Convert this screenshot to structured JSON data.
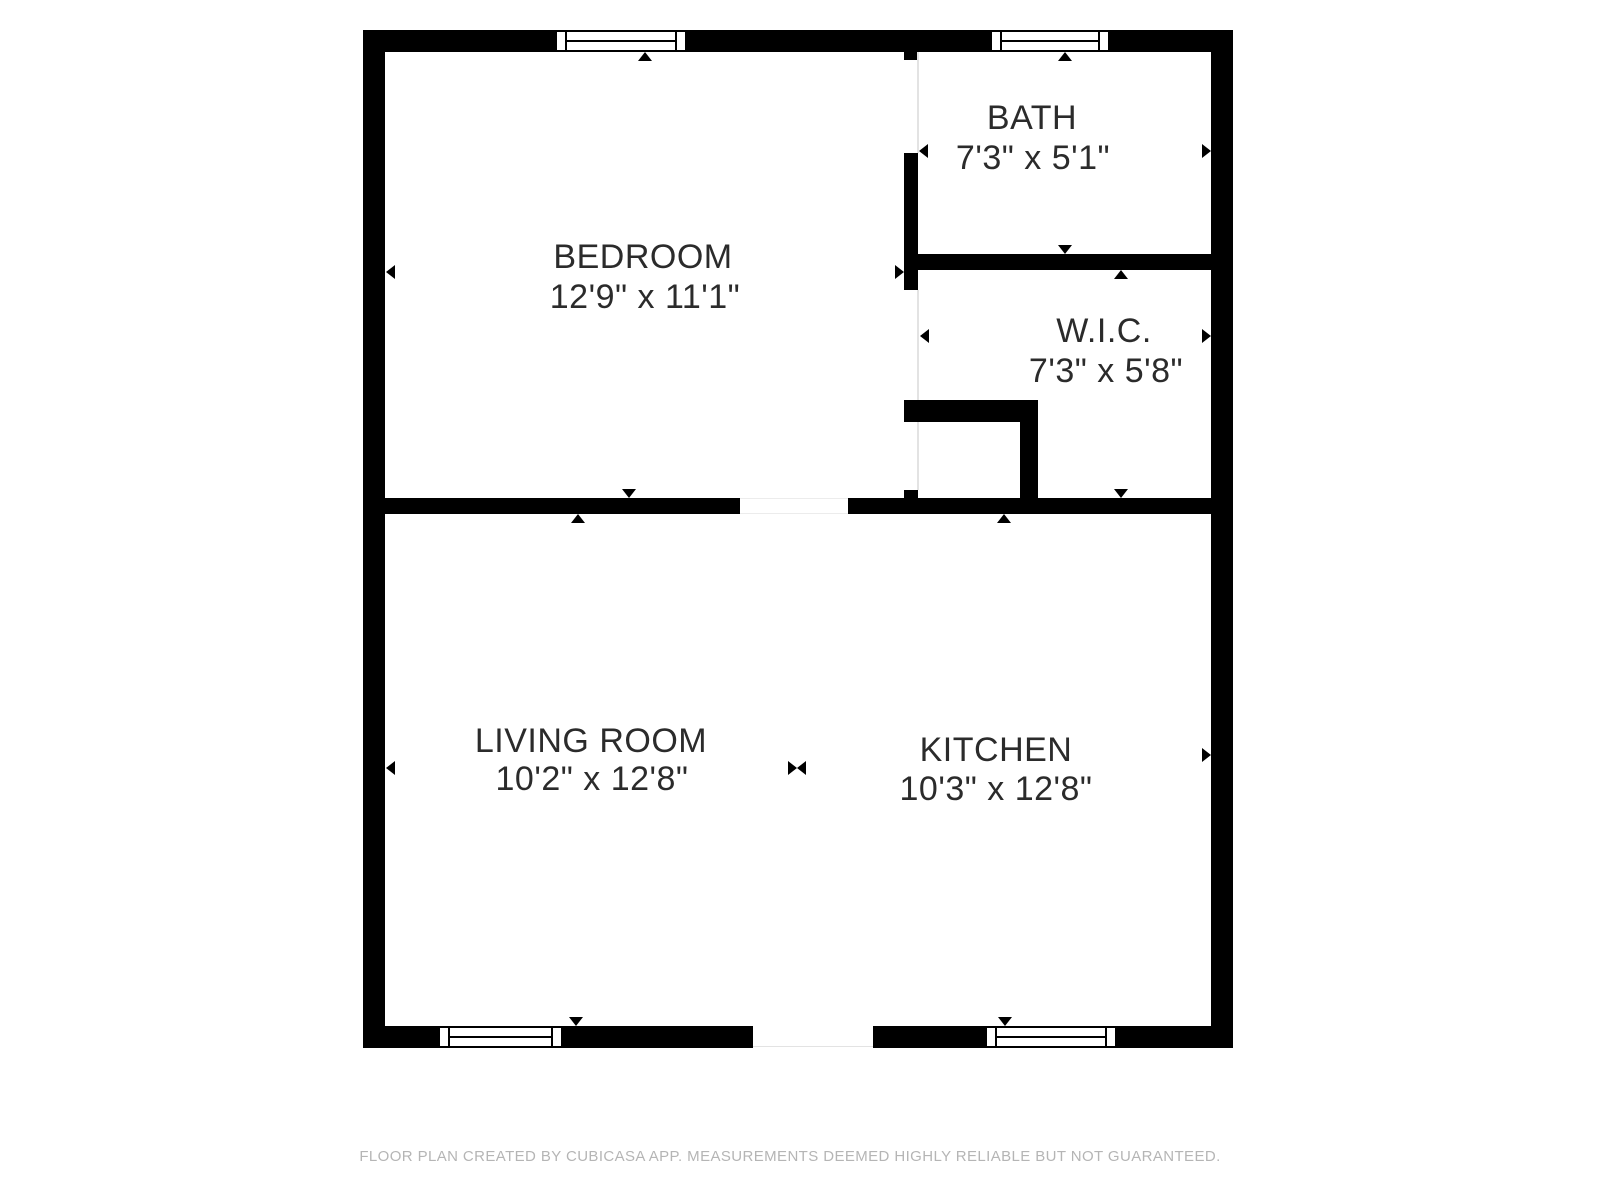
{
  "plan": {
    "rooms": [
      {
        "name": "BEDROOM",
        "dims": "12'9\" x 11'1\""
      },
      {
        "name": "BATH",
        "dims": "7'3\" x 5'1\""
      },
      {
        "name": "W.I.C.",
        "dims": "7'3\" x 5'8\""
      },
      {
        "name": "LIVING ROOM",
        "dims": "10'2\" x 12'8\""
      },
      {
        "name": "KITCHEN",
        "dims": "10'3\" x 12'8\""
      }
    ],
    "footer": "FLOOR PLAN CREATED BY CUBICASA APP. MEASUREMENTS DEEMED HIGHLY RELIABLE BUT NOT GUARANTEED.",
    "colors": {
      "wall": "#000000",
      "room_text": "#2b2b2b",
      "footer_text": "#b5b5b5",
      "background": "#ffffff",
      "opening_line": "#e3e3e3"
    },
    "icons": {
      "measure_marker": "filled triangle pointing toward wall",
      "double_measure_marker": "two triangles tip-to-tip at open room boundary"
    }
  }
}
